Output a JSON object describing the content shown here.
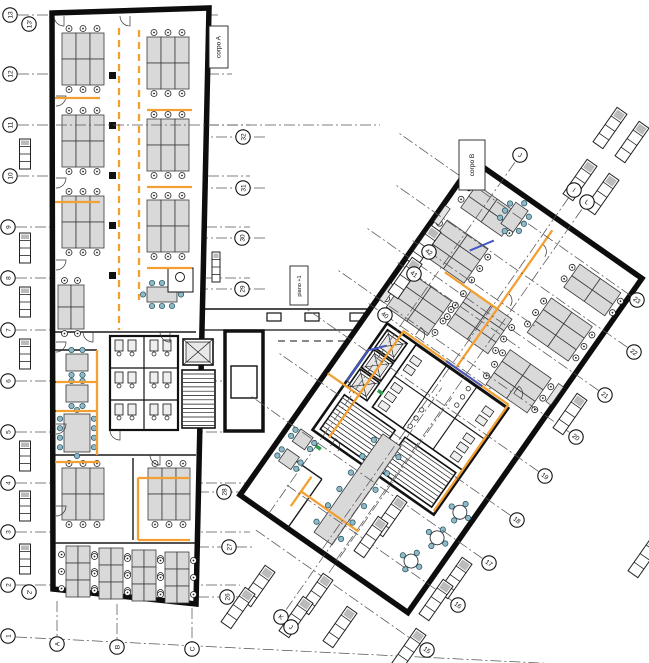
{
  "drawing": {
    "floor_label": "piano +1",
    "wing_a_label": "corpo A",
    "wing_b_label": "corpo B"
  },
  "grid_bubbles": {
    "left": [
      "13",
      "13'",
      "12",
      "11",
      "10",
      "9",
      "8",
      "7",
      "6",
      "5",
      "4",
      "3",
      "2",
      "2'",
      "1"
    ],
    "bottom": [
      "A",
      "B",
      "C"
    ],
    "corpo_a_right": [
      "32",
      "31",
      "30",
      "29",
      "28",
      "27",
      "26"
    ],
    "corpo_b_southeast": [
      "23",
      "22",
      "21",
      "20",
      "19",
      "18",
      "17",
      "16",
      "15"
    ],
    "corpo_b_northwest": [
      "42",
      "41",
      "40"
    ],
    "corpo_b_letters_top": [
      "J",
      "I",
      "L"
    ],
    "corpo_b_letters_bottom": [
      "K",
      "J"
    ]
  },
  "colors": {
    "walls": "#0d0d0d",
    "desk_fill": "#d9d9d9",
    "office_chair": "#ffffff",
    "meeting_chair": "#8fb9c7",
    "route_orange": "#f2a033",
    "route_blue": "#4458c8",
    "accent_green": "#2e9e4f",
    "grid_line": "#555555"
  }
}
